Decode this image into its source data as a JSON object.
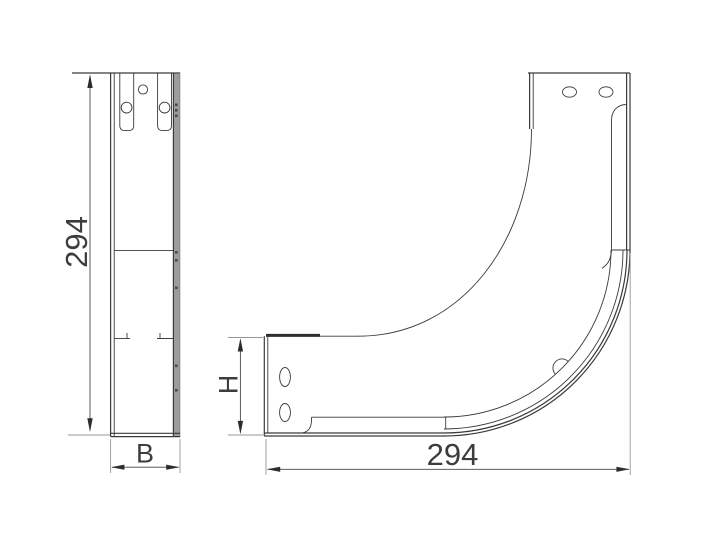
{
  "drawing": {
    "description_labels": {
      "front_view": {
        "height_label": "294",
        "width_label": "B"
      },
      "side_view": {
        "height_label": "H",
        "length_label": "294"
      }
    },
    "colors": {
      "background": "#ffffff",
      "part_line": "#3a3a3a",
      "dimension_line": "#474747",
      "extension_line": "#979797",
      "steel_edge_fill": "#9c9c9c",
      "label_text": "#3d3d3d"
    }
  }
}
